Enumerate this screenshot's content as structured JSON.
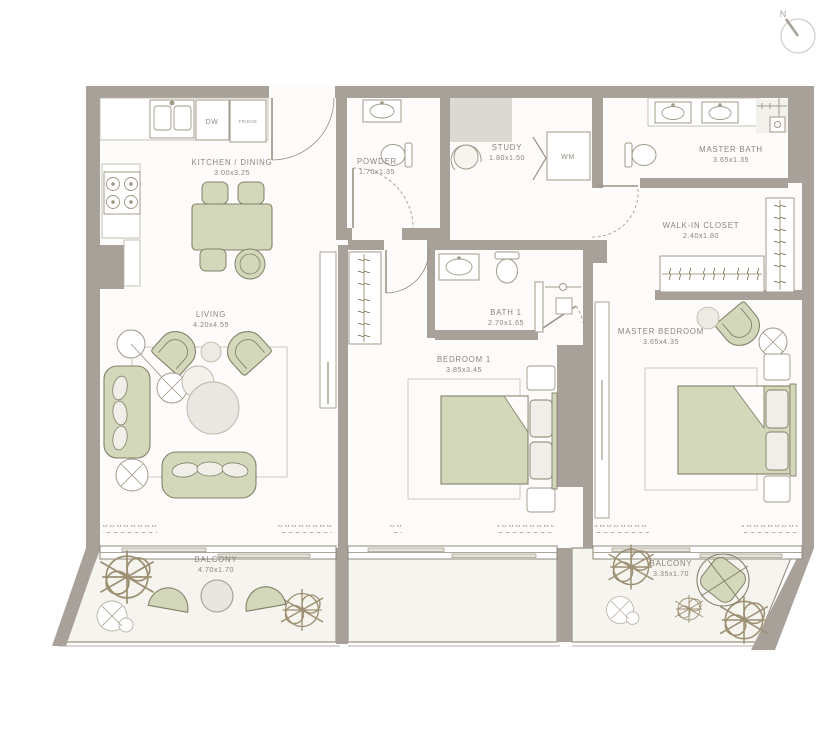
{
  "compass": {
    "label": "N"
  },
  "rooms": [
    {
      "name": "KITCHEN / DINING",
      "dims": "3.00x3.25"
    },
    {
      "name": "POWDER",
      "dims": "1.70x1.35"
    },
    {
      "name": "STUDY",
      "dims": "1.80x1.50"
    },
    {
      "name": "MASTER BATH",
      "dims": "3.65x1.35"
    },
    {
      "name": "WALK-IN CLOSET",
      "dims": "2.40x1.80"
    },
    {
      "name": "LIVING",
      "dims": "4.20x4.55"
    },
    {
      "name": "BATH 1",
      "dims": "2.70x1.65"
    },
    {
      "name": "BEDROOM 1",
      "dims": "3.85x3.45"
    },
    {
      "name": "MASTER BEDROOM",
      "dims": "3.65x4.35"
    },
    {
      "name": "BALCONY",
      "dims": "4.70x1.70"
    },
    {
      "name": "BALCONY",
      "dims": "3.35x1.70"
    }
  ],
  "appliances": {
    "dishwasher": "DW",
    "fridge": "FRIDGE",
    "washing_machine": "WM"
  },
  "colors": {
    "wall": "#a8a199",
    "light_block": "#dcd8d2",
    "floor": "#fdfcfa",
    "balcony_floor": "#f6f4ef",
    "furniture_green": "#d3d8bb",
    "furniture_green_outline": "#84806a",
    "fixture_outline": "#a29a8a",
    "label_text": "#8b857b",
    "rug_outline": "#cdc8bd",
    "window_line": "#8f887a"
  }
}
